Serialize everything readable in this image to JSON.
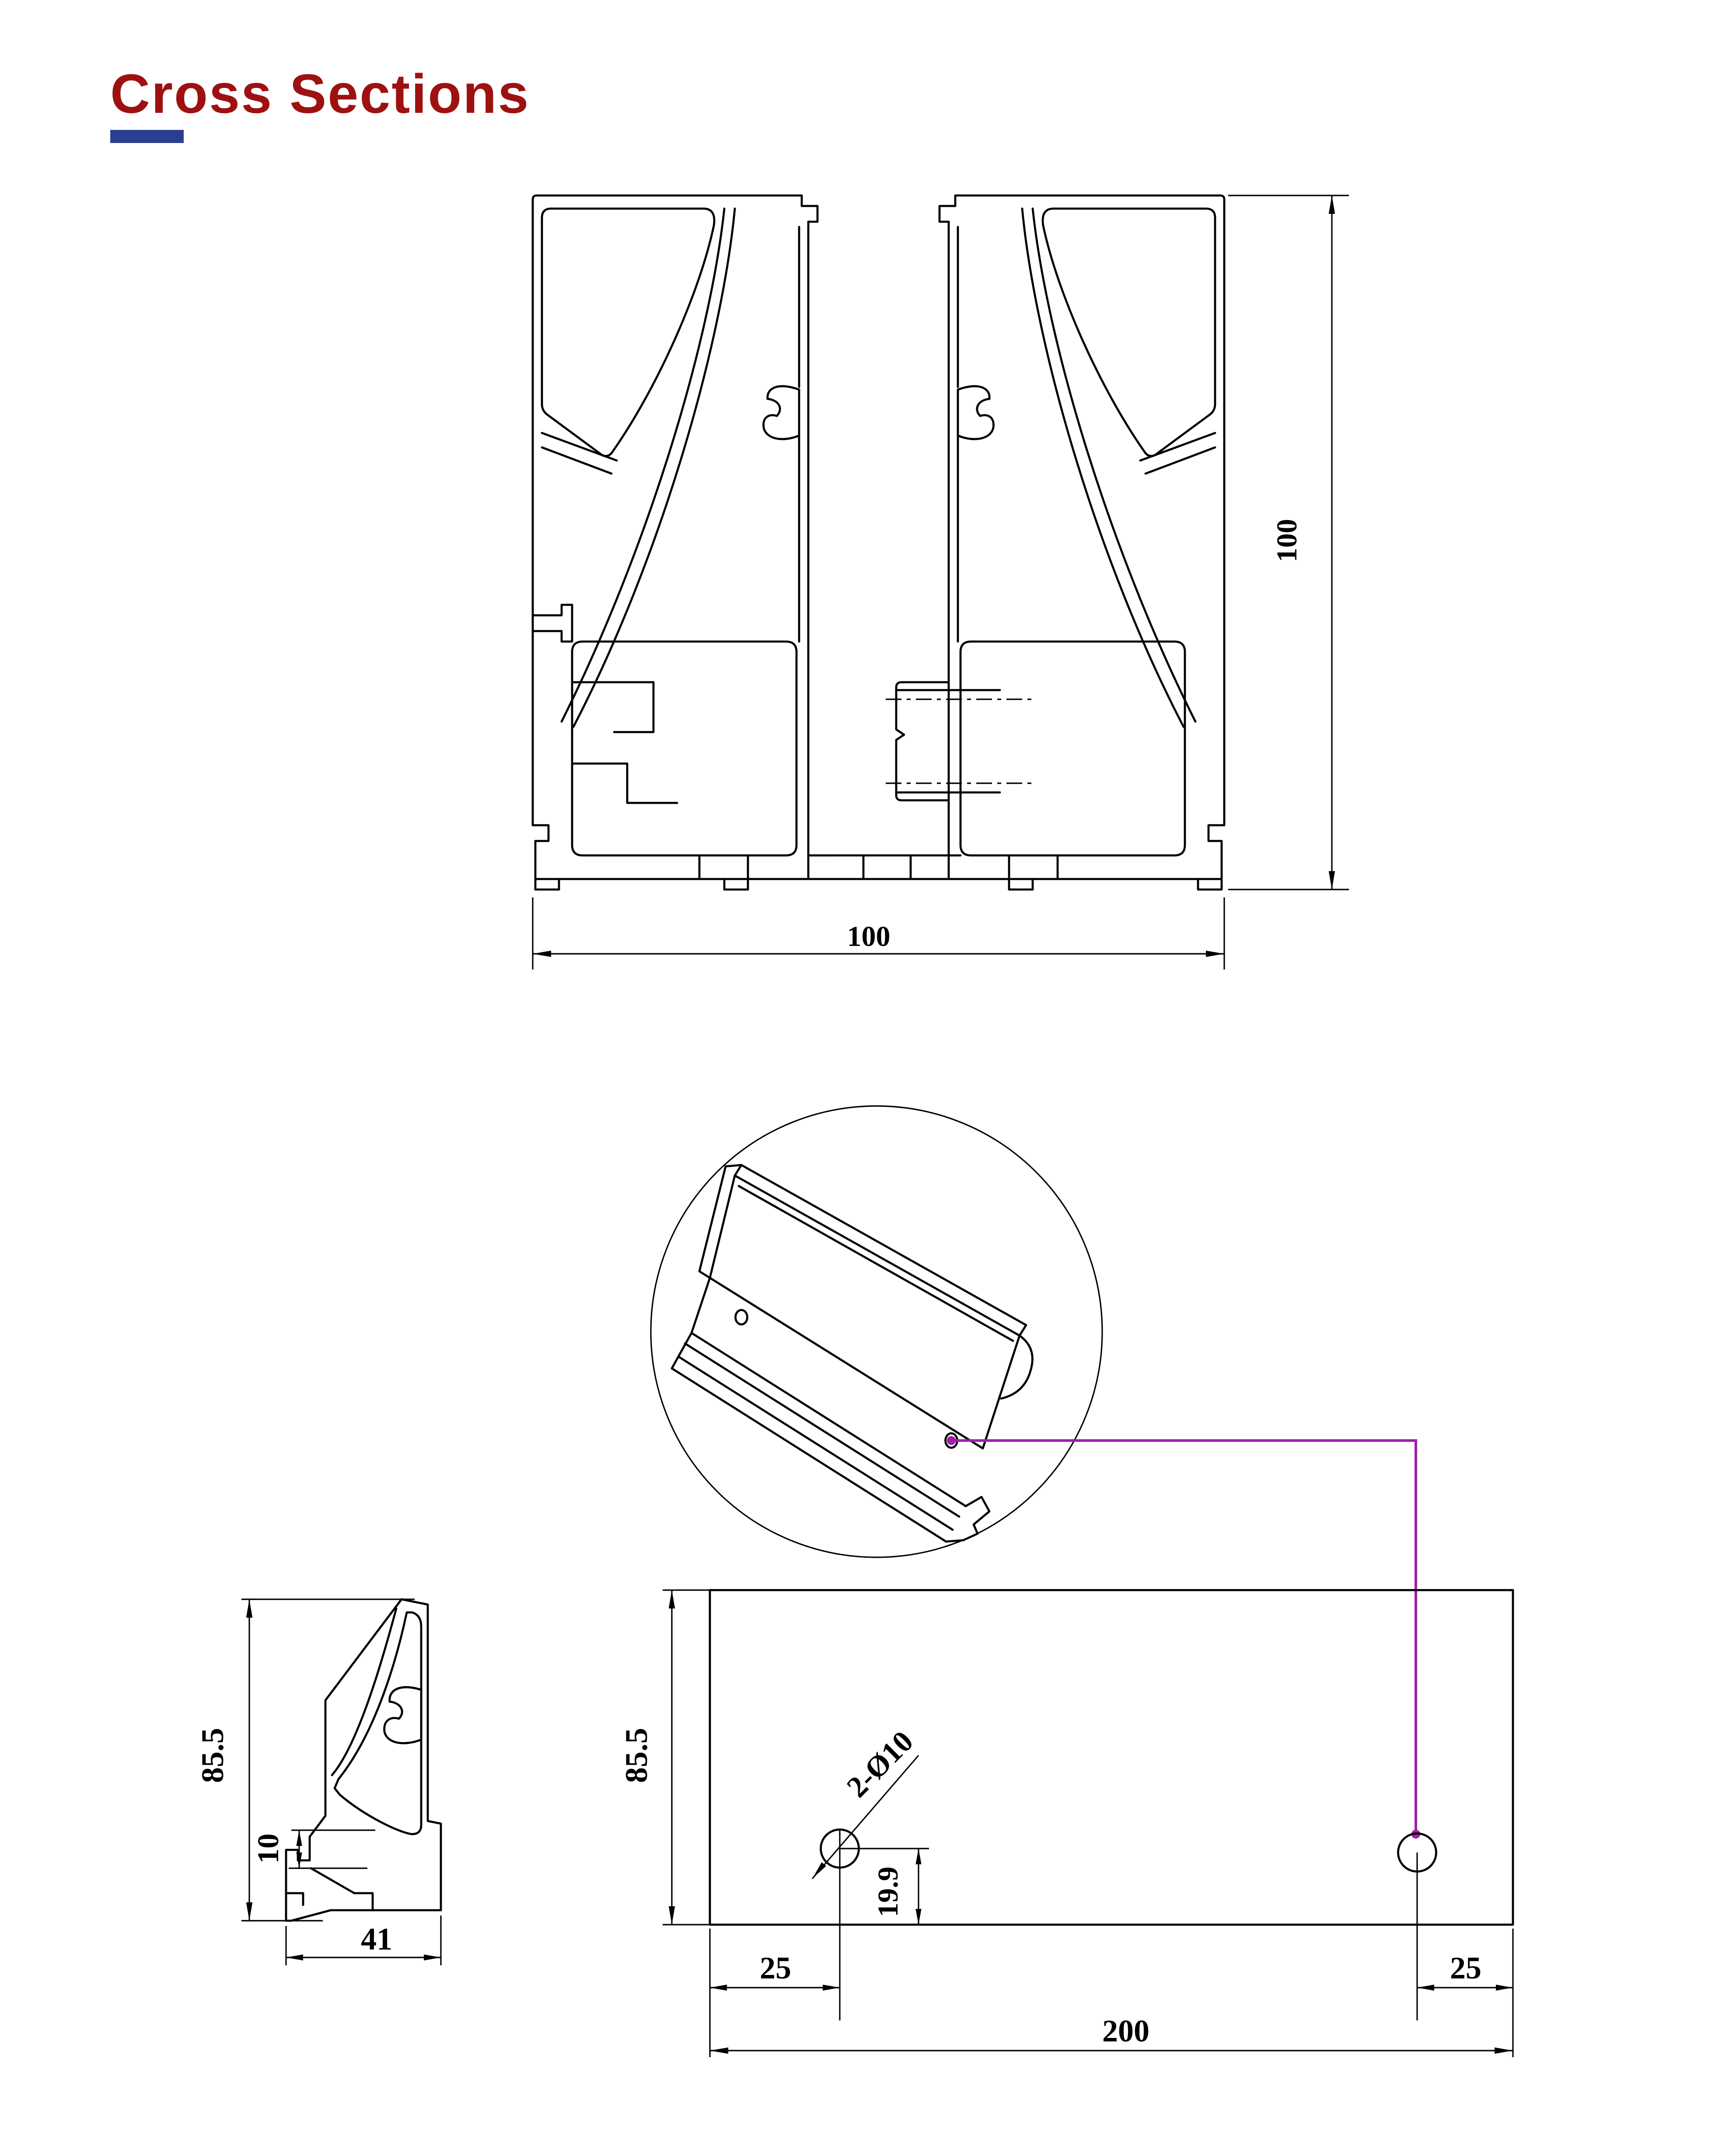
{
  "title": {
    "text": "Cross Sections"
  },
  "colors": {
    "title": "#9E1111",
    "underline": "#2B3F92",
    "line": "#000000",
    "leader": "#A020A8",
    "background": "#FFFFFF"
  },
  "assembly_view": {
    "dim_height": "100",
    "dim_width": "100"
  },
  "adapter_view": {
    "dim_height": "85.5",
    "dim_offset": "10",
    "dim_width": "41"
  },
  "plate_view": {
    "dim_height": "85.5",
    "dim_hole_callout": "2-Ø10",
    "dim_hole_bottom_offset": "19.9",
    "dim_left_margin": "25",
    "dim_right_margin": "25",
    "dim_width": "200"
  }
}
